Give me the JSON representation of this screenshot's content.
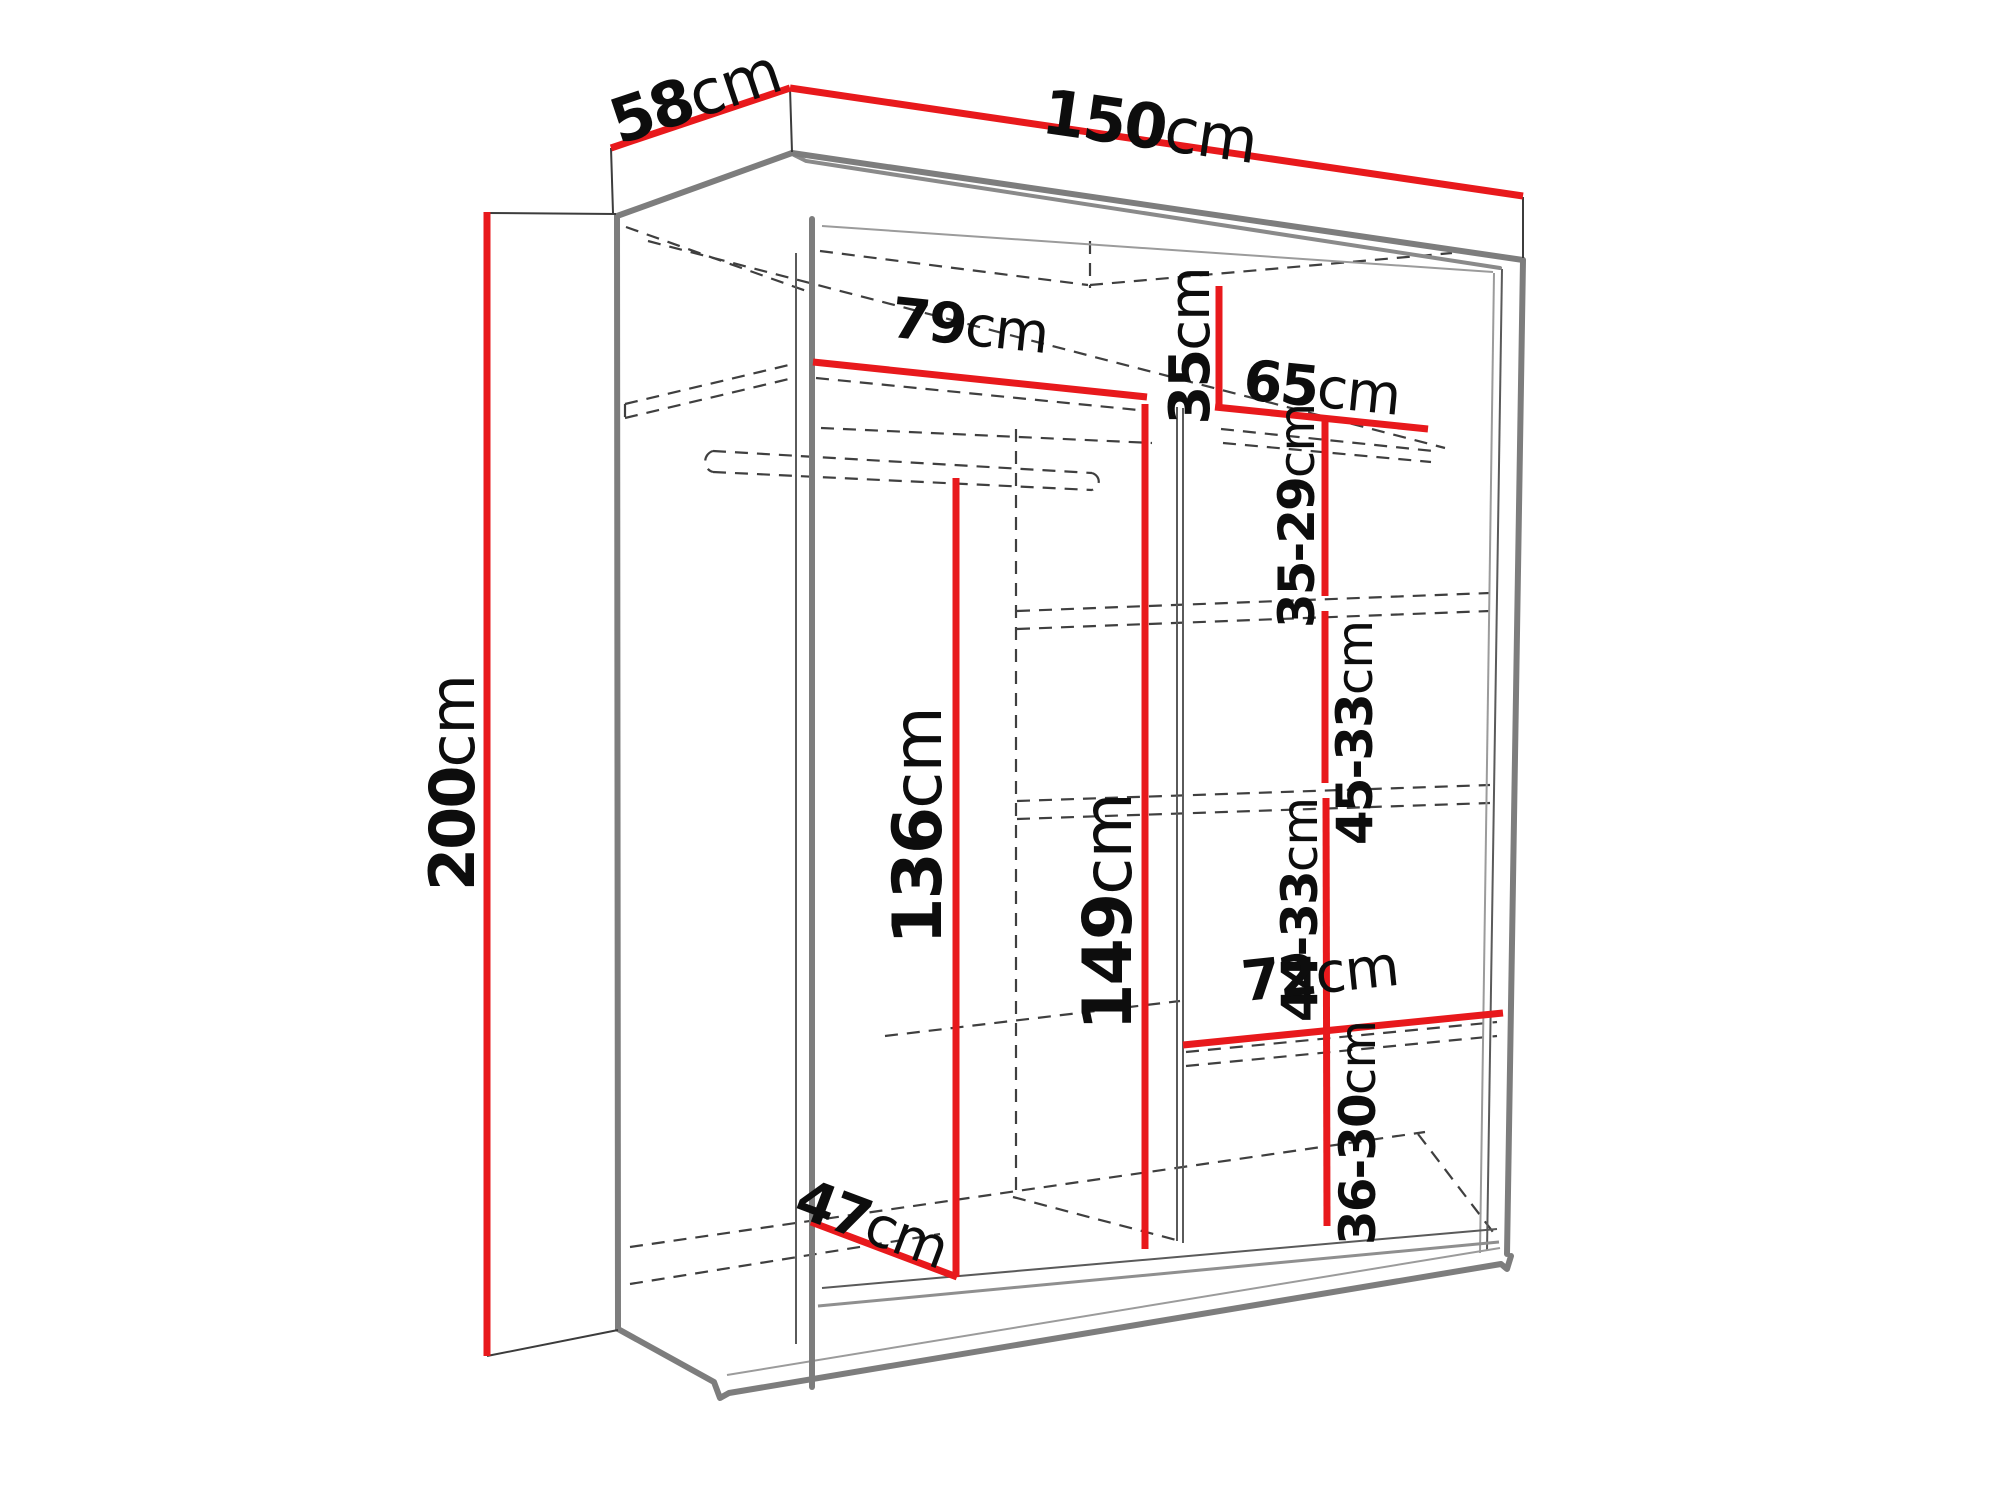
{
  "diagram": {
    "kind": "wardrobe-dimension-drawing",
    "unit": "cm",
    "colors": {
      "dimension_line": "#e8191c",
      "outline": "#7d7d7d",
      "hidden_line": "#3f3f3f",
      "label_text": "#0d0d0d",
      "background": "#ffffff"
    },
    "labels": {
      "depth": {
        "number": "58",
        "unit": "cm"
      },
      "width": {
        "number": "150",
        "unit": "cm"
      },
      "height": {
        "number": "200",
        "unit": "cm"
      },
      "top_shelf_left_width": {
        "number": "79",
        "unit": "cm"
      },
      "top_right_height": {
        "number": "35",
        "unit": "cm"
      },
      "top_shelf_right_width": {
        "number": "65",
        "unit": "cm"
      },
      "hanging_space_height": {
        "number": "136",
        "unit": "cm"
      },
      "middle_space_height": {
        "number": "149",
        "unit": "cm"
      },
      "shelf_gap_1": {
        "number": "35-29",
        "unit": "cm"
      },
      "shelf_gap_2": {
        "number": "45-33",
        "unit": "cm"
      },
      "shelf_gap_3": {
        "number": "44-33",
        "unit": "cm"
      },
      "bottom_shelf_width": {
        "number": "72",
        "unit": "cm"
      },
      "shelf_gap_4": {
        "number": "36-30",
        "unit": "cm"
      },
      "bottom_depth": {
        "number": "47",
        "unit": "cm"
      }
    }
  }
}
